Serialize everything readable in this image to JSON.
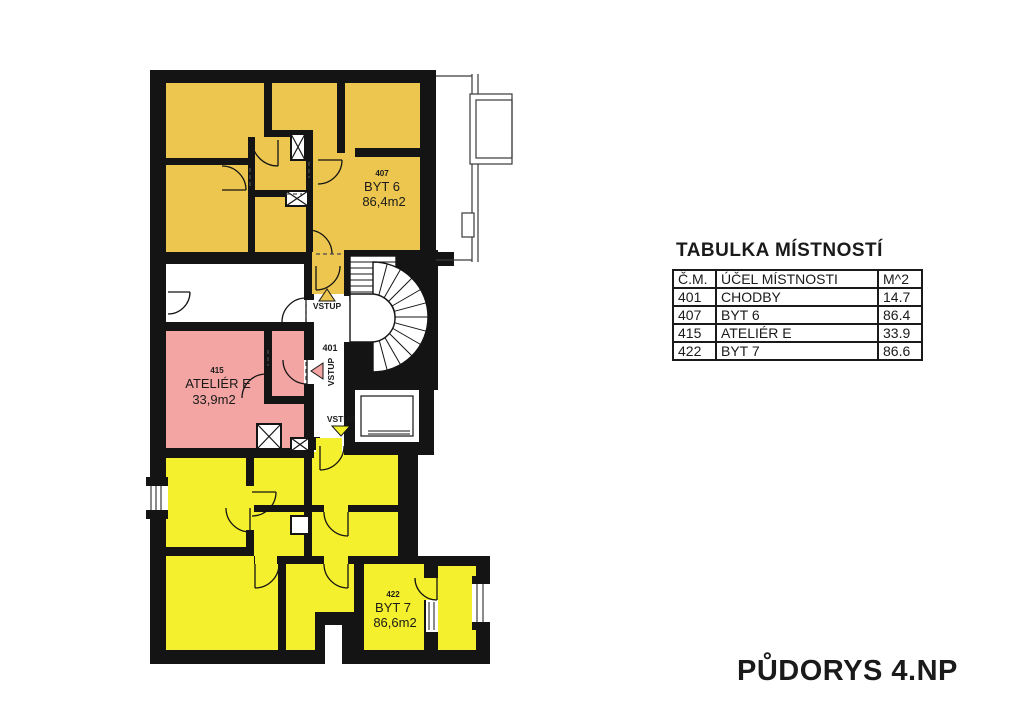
{
  "plan": {
    "drawing_title": "PŮDORYS 4.NP",
    "corridor": {
      "id": "401"
    },
    "rooms": {
      "byt6": {
        "id": "407",
        "name": "BYT 6",
        "area": "86,4m2"
      },
      "atelier": {
        "id": "415",
        "name": "ATELIÉR E",
        "area": "33,9m2"
      },
      "byt7": {
        "id": "422",
        "name": "BYT 7",
        "area": "86,6m2"
      }
    },
    "entrance_label": "VSTUP",
    "colors": {
      "byt6": "#ECC64F",
      "atelier": "#F2A5A3",
      "byt7": "#F5F02D",
      "wall": "#141414"
    }
  },
  "table": {
    "title": "TABULKA MÍSTNOSTÍ",
    "headers": {
      "num": "Č.M.",
      "purpose": "ÚČEL MÍSTNOSTI",
      "area": "M^2"
    },
    "rows": [
      {
        "num": "401",
        "purpose": "CHODBY",
        "area": "14.7"
      },
      {
        "num": "407",
        "purpose": "BYT 6",
        "area": "86.4"
      },
      {
        "num": "415",
        "purpose": "ATELIÉR E",
        "area": "33.9"
      },
      {
        "num": "422",
        "purpose": "BYT 7",
        "area": "86.6"
      }
    ]
  }
}
